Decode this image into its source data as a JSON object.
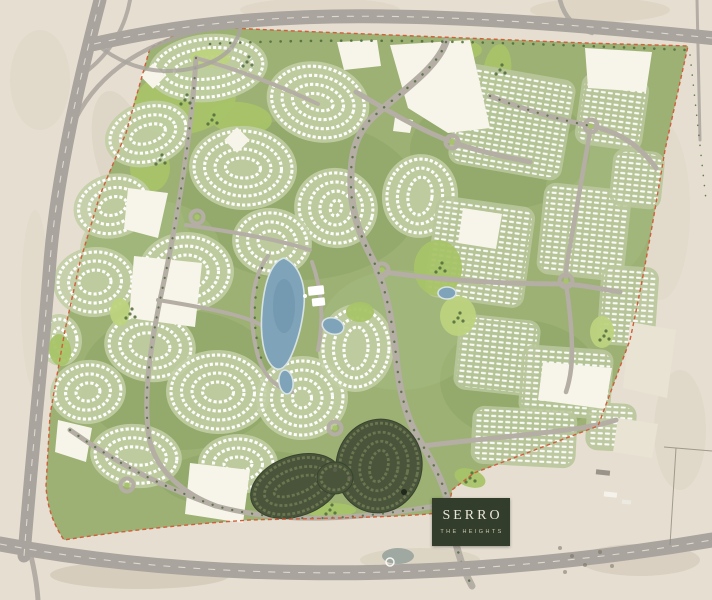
{
  "logo": {
    "title": "SERRO",
    "subtitle": "THE HEIGHTS"
  },
  "palette": {
    "desert": "#e6dfd1",
    "desertShade": "#d3c9b6",
    "roadOuter": "#a9a49e",
    "roadInner": "#b4aea4",
    "siteBase": "#9cb173",
    "siteVein": "#8aa264",
    "park": "#a8c468",
    "parkLight": "#bdd37e",
    "house": "#ffffff",
    "clusterBase": "#c2cea4",
    "gridBase": "#b9c69b",
    "water": "#7fa3b8",
    "waterDeep": "#6d94ab",
    "waterEdge": "#d6e2e4",
    "darkCluster": "#49543b",
    "darkHouse": "#6b7850",
    "boundary": "#cf5f3c",
    "tree": "#4f6a3c",
    "plot": "#f7f4ea",
    "logoBg": "#333d2c",
    "logoText": "#eae6d7",
    "logoSub": "#cdc7ae"
  }
}
